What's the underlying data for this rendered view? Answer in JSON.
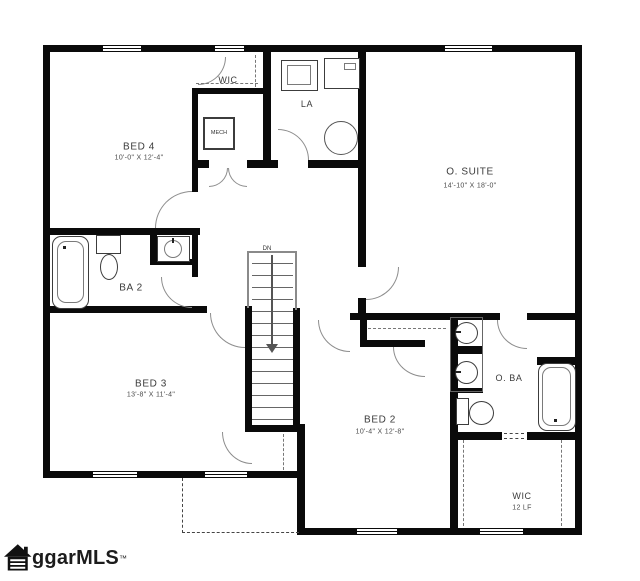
{
  "plan": {
    "rooms": {
      "bed4": {
        "name": "BED 4",
        "dims": "10'-0\" X 12'-4\""
      },
      "wic_top": {
        "name": "WIC"
      },
      "laundry": {
        "name": "LA"
      },
      "mech": {
        "name": "MECH"
      },
      "osuite": {
        "name": "O. SUITE",
        "dims": "14'-10\" X 18'-0\""
      },
      "ba2": {
        "name": "BA 2"
      },
      "bed3": {
        "name": "BED 3",
        "dims": "13'-8\" X 11'-4\""
      },
      "bed2": {
        "name": "BED 2",
        "dims": "10'-4\" X 12'-8\""
      },
      "oba": {
        "name": "O. BA"
      },
      "wic_bottom": {
        "name": "WIC",
        "dims": "12 LF"
      }
    },
    "stairs": {
      "direction_label": "DN"
    },
    "colors": {
      "wall": "#0a0a0a",
      "fixture_line": "#3c3c3c",
      "text": "#3b3b3b"
    }
  },
  "branding": {
    "logo_text": "ggarMLS",
    "trademark": "™"
  }
}
